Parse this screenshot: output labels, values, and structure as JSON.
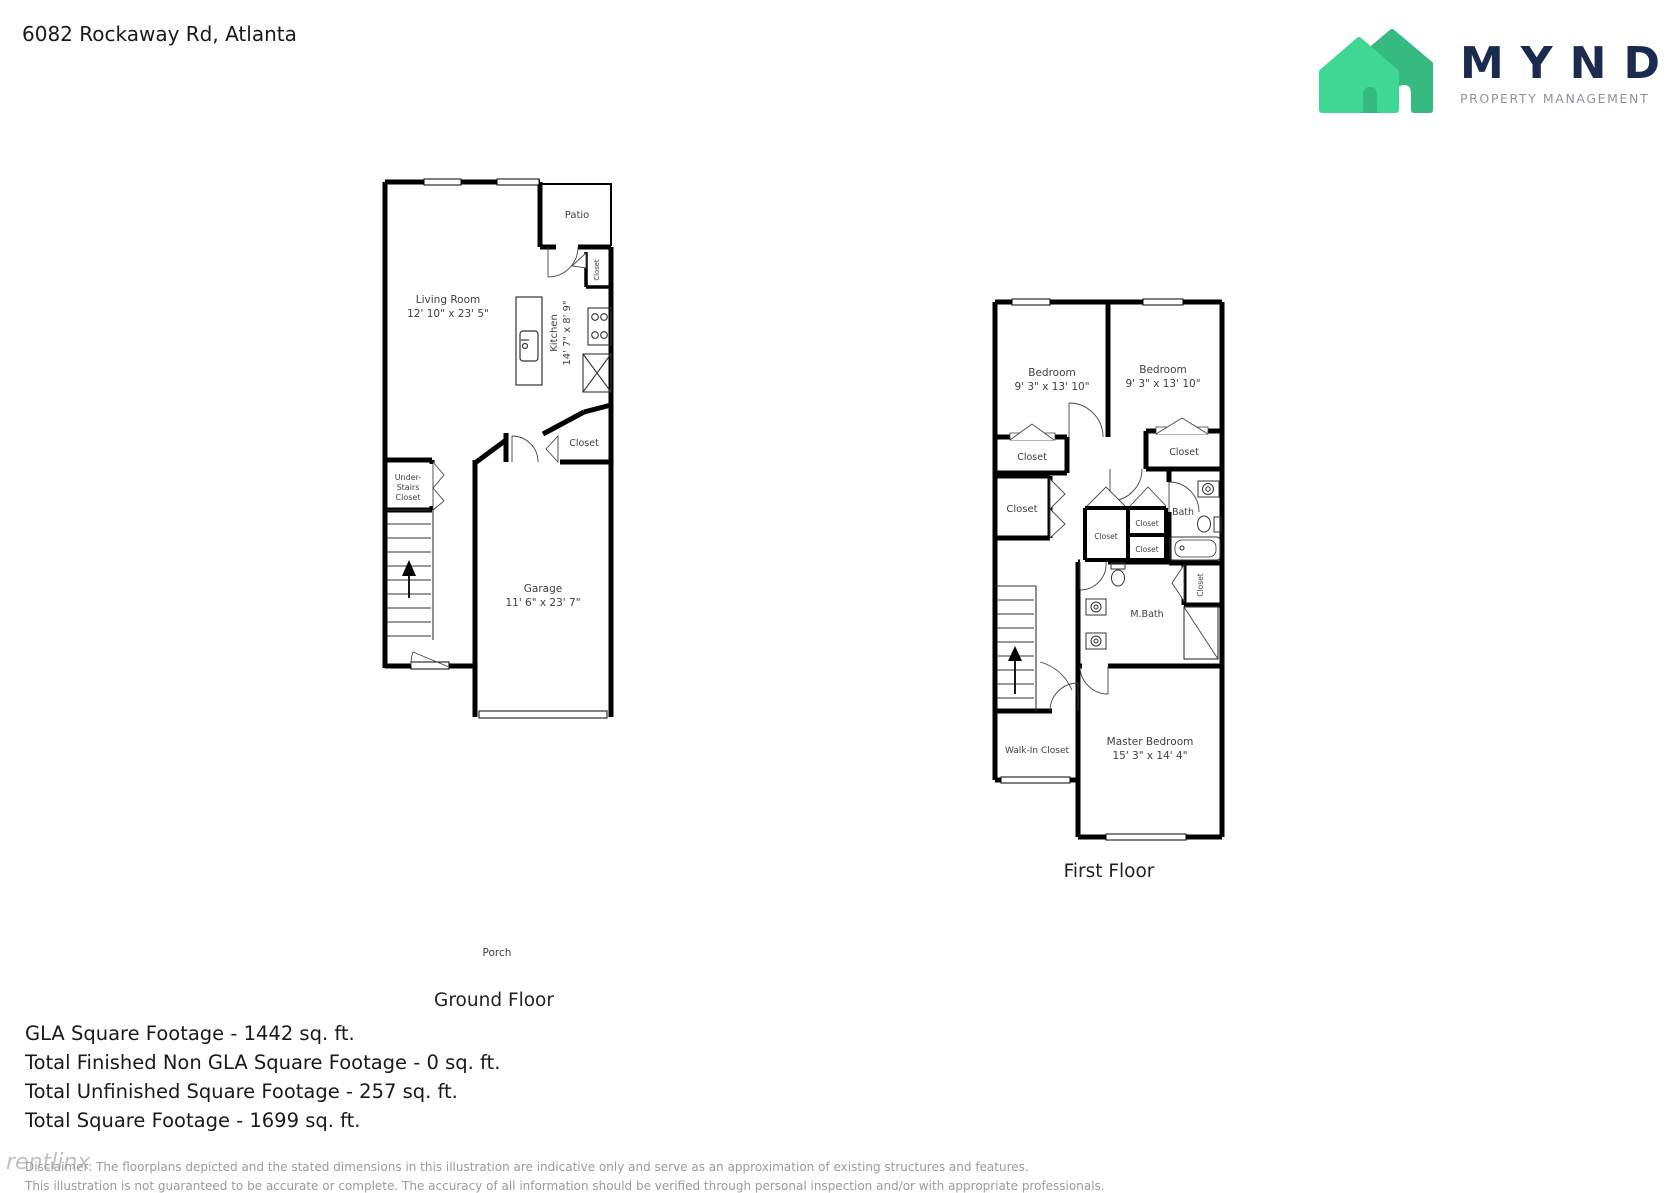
{
  "header": {
    "address": "6082 Rockaway Rd, Atlanta"
  },
  "logo": {
    "wordmark": "MYND",
    "tagline": "PROPERTY MANAGEMENT",
    "colors": {
      "house_front": "#3FD794",
      "house_back": "#35BA81",
      "wordmark": "#1A2B4F",
      "tagline": "#8D949D"
    }
  },
  "ground_floor": {
    "title": "Ground Floor",
    "porch_label": "Porch",
    "living_room": {
      "name": "Living Room",
      "dims": "12' 10\" x 23' 5\""
    },
    "kitchen": {
      "name": "Kitchen",
      "dims": "14' 7\" x 8' 9\""
    },
    "patio_label": "Patio",
    "patio_closet_label": "Closet",
    "hall_closet_label": "Closet",
    "under_stairs_closet": {
      "line1": "Under-",
      "line2": "Stairs",
      "line3": "Closet"
    },
    "garage": {
      "name": "Garage",
      "dims": "11' 6\" x 23' 7\""
    }
  },
  "first_floor": {
    "title": "First Floor",
    "bedroom_left": {
      "name": "Bedroom",
      "dims": "9' 3\" x 13' 10\""
    },
    "bedroom_right": {
      "name": "Bedroom",
      "dims": "9' 3\" x 13' 10\""
    },
    "closet_label": "Closet",
    "bath_label": "Bath",
    "mbath_label": "M.Bath",
    "walk_in_closet_label": "Walk-In Closet",
    "master_bedroom": {
      "name": "Master Bedroom",
      "dims": "15' 3\" x 14' 4\""
    }
  },
  "footer": {
    "stats": [
      "GLA Square Footage - 1442 sq. ft.",
      "Total Finished Non GLA Square Footage - 0 sq. ft.",
      "Total Unfinished Square Footage - 257 sq. ft.",
      "Total Square Footage - 1699 sq. ft."
    ],
    "disclaimer_line1": "Disclaimer: The floorplans depicted and the stated dimensions in this illustration are indicative only and serve as an approximation of existing structures and features.",
    "disclaimer_line2": "This illustration is not guaranteed to be accurate or complete. The accuracy of all information should be verified through personal inspection and/or with appropriate professionals.",
    "watermark": "rentlinx"
  }
}
